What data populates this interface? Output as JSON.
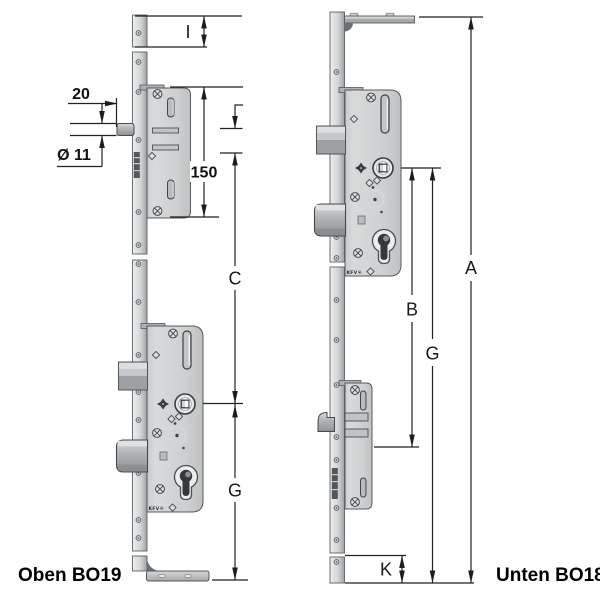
{
  "drawing": {
    "caption_left": "Oben BO19",
    "caption_right": "Unten BO18",
    "brand": "KFV®",
    "dims_left": {
      "top_offset": "I",
      "latch_projection": "20",
      "latch_diameter": "Ø 11",
      "extension_length": "150",
      "latch_to_spindle": "C",
      "spindle_to_bottom": "G"
    },
    "dims_right": {
      "total_length": "A",
      "spindle_to_gearbox": "B",
      "spindle_to_bottom": "G",
      "bottom_offset": "K"
    },
    "colors": {
      "background": "#ffffff",
      "metal_light": "#e9eaeb",
      "metal_mid": "#cfd1d2",
      "metal_dark": "#8f9294",
      "outline": "#4b4f52",
      "dimension_line": "#222222",
      "label_text": "#1a1a1a"
    }
  }
}
